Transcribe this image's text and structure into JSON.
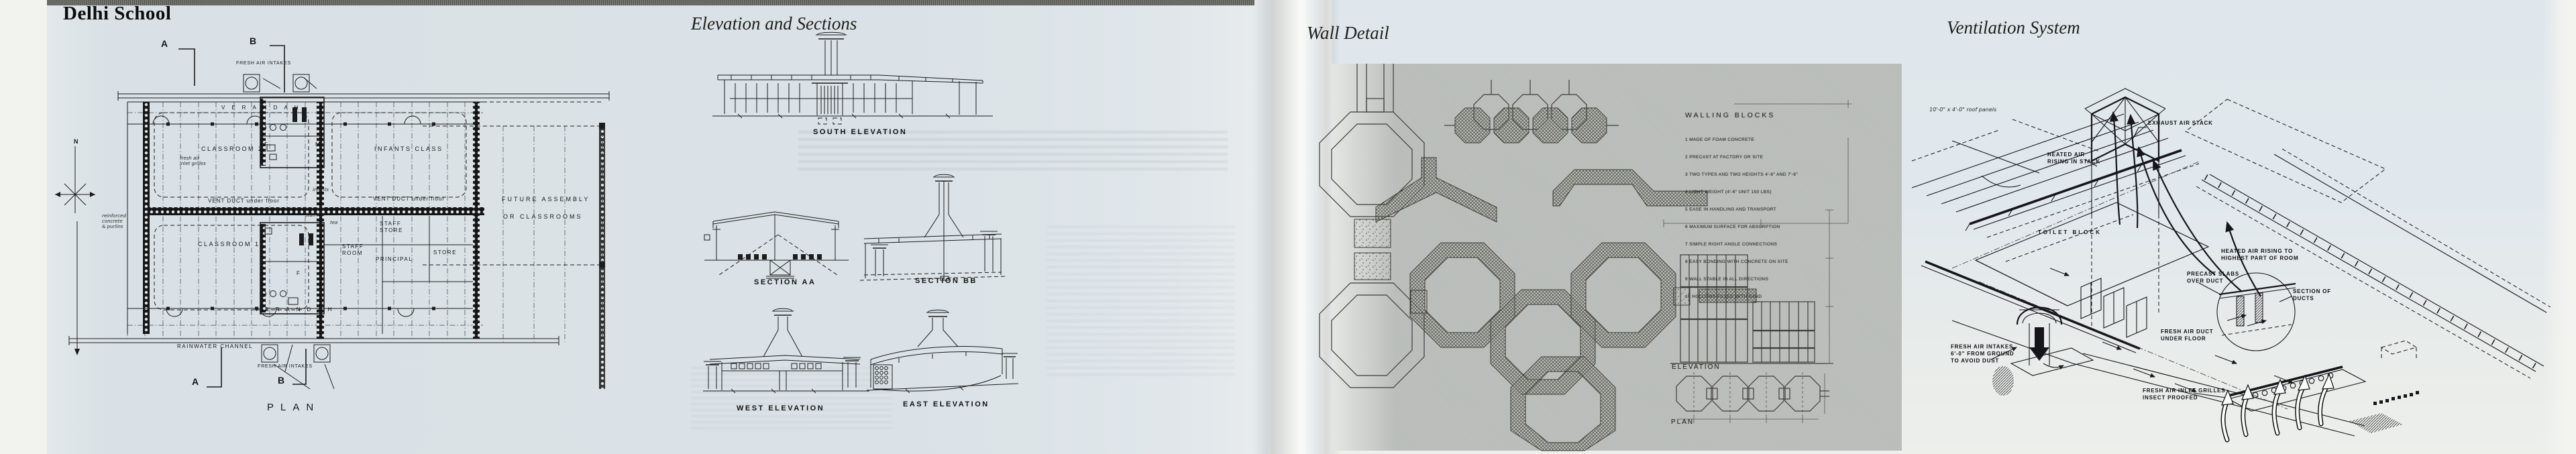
{
  "plan": {
    "title": "Delhi School",
    "north": "N",
    "marker_a_top": "A",
    "marker_b_top": "B",
    "marker_a_bottom": "A",
    "marker_b_bottom": "B",
    "fresh_air_intakes_top": "FRESH AIR INTAKES",
    "fresh_air_intakes_bottom": "FRESH AIR INTAKES",
    "verandah_top": "VERANDAH",
    "verandah_bottom": "VERANDAH",
    "classroom_2": "CLASSROOM 2",
    "classroom_1": "CLASSROOM 1",
    "infants_class": "INFANTS CLASS",
    "vent_duct_left": "VENT DUCT under floor",
    "vent_duct_right": "VENT DUCT under floor",
    "staff_store": "STAFF\nSTORE",
    "store": "STORE",
    "staff_room": "STAFF\nROOM",
    "principal": "PRINCIPAL",
    "future_assembly": "FUTURE ASSEMBLY",
    "or_classrooms": "OR CLASSROOMS",
    "f_top": "F",
    "m_top": "M",
    "f_bottom": "F",
    "m_bottom": "M",
    "infants_note": "infants",
    "staff_note": "staff",
    "tea_note": "tea",
    "grilles_note": "fresh air\ninlet grilles",
    "concrete_note": "reinforced\nconcrete\n& purlins",
    "rainwater_channel": "RAINWATER CHANNEL",
    "plan_caption": "PLAN"
  },
  "elevations": {
    "title": "Elevation and Sections",
    "items": [
      {
        "label": "SOUTH ELEVATION"
      },
      {
        "label": "SECTION AA"
      },
      {
        "label": "SECTION BB"
      },
      {
        "label": "WEST ELEVATION"
      },
      {
        "label": "EAST ELEVATION"
      }
    ]
  },
  "wall_detail": {
    "title": "Wall Detail",
    "heading": "WALLING BLOCKS",
    "items": [
      "1  MADE OF FOAM CONCRETE",
      "2  PRECAST AT FACTORY OR SITE",
      "3  TWO TYPES AND TWO HEIGHTS 4'-6\" AND 7'-6\"",
      "4  LIGHT WEIGHT (4'-6\" UNIT  150 LBS)",
      "5  EASE IN HANDLING AND TRANSPORT",
      "6  MAXIMUM SURFACE FOR ABSORPTION",
      "7  SIMPLE RIGHT ANGLE CONNECTIONS",
      "8  EASY BONDING WITH CONCRETE ON SITE",
      "9  WALL STABLE IN ALL DIRECTIONS",
      "10 HOLLOWS FILLED WITH SAND"
    ],
    "elevation_caption": "ELEVATION",
    "plan_caption": "PLAN"
  },
  "ventilation": {
    "title": "Ventilation System",
    "roof_panels_note": "10'-0\" x 4'-0\" roof panels",
    "exhaust_air_stack": "EXHAUST AIR STACK",
    "heated_air_stack": "HEATED AIR\nRISING IN STACK",
    "toilet_block": "TOILET BLOCK",
    "heated_air_room": "HEATED AIR RISING TO\nHIGHEST PART OF ROOM",
    "precast_slabs": "PRECAST SLABS\nOVER DUCT",
    "section_of_ducts": "SECTION OF\nDUCTS",
    "fresh_air_intakes": "FRESH AIR INTAKES\n6'-0\" FROM GROUND\nTO AVOID DUST",
    "fresh_air_duct": "FRESH AIR DUCT\nUNDER FLOOR",
    "inlet_grilles": "FRESH AIR INLET GRILLES\nINSECT PROOFED"
  }
}
